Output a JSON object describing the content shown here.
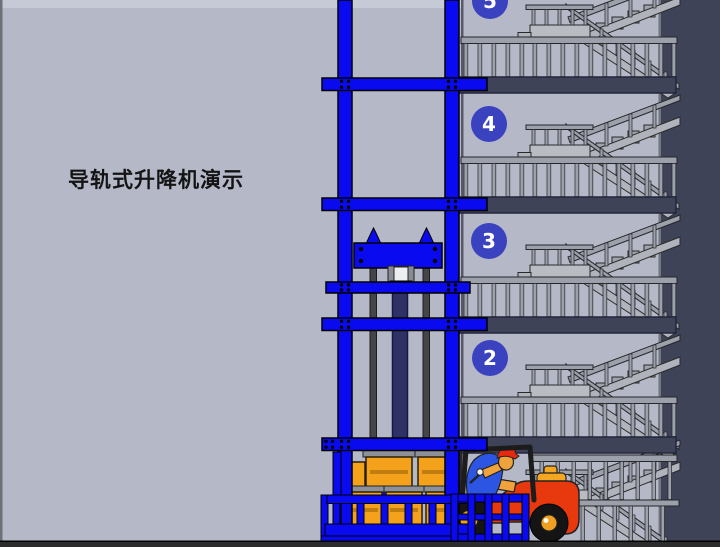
{
  "title": "导轨式升降机演示",
  "floor_badges": [
    {
      "number": "5"
    },
    {
      "number": "4"
    },
    {
      "number": "3"
    },
    {
      "number": "2"
    }
  ],
  "colors": {
    "bg-light": "#b5b8c7",
    "bg-top-strip": "#c6c9d6",
    "navy": "#3e4358",
    "circle-blue": "#3a42c0",
    "mast-blue": "#0a0af0",
    "stair-gray": "#b0b3bb",
    "rail-gray": "#9ba0aa",
    "rod-gray": "#454549",
    "cylinder-navy": "#2e3166",
    "crate-orange": "#f4a11b",
    "lid-gray": "#8d9098",
    "forklift-red": "#e8380d",
    "counter-yellow": "#f5a623",
    "shirt-blue": "#2b55e2",
    "skin": "#f0a23c",
    "cap-red": "#e82810",
    "ground": "#2c2c2c"
  }
}
